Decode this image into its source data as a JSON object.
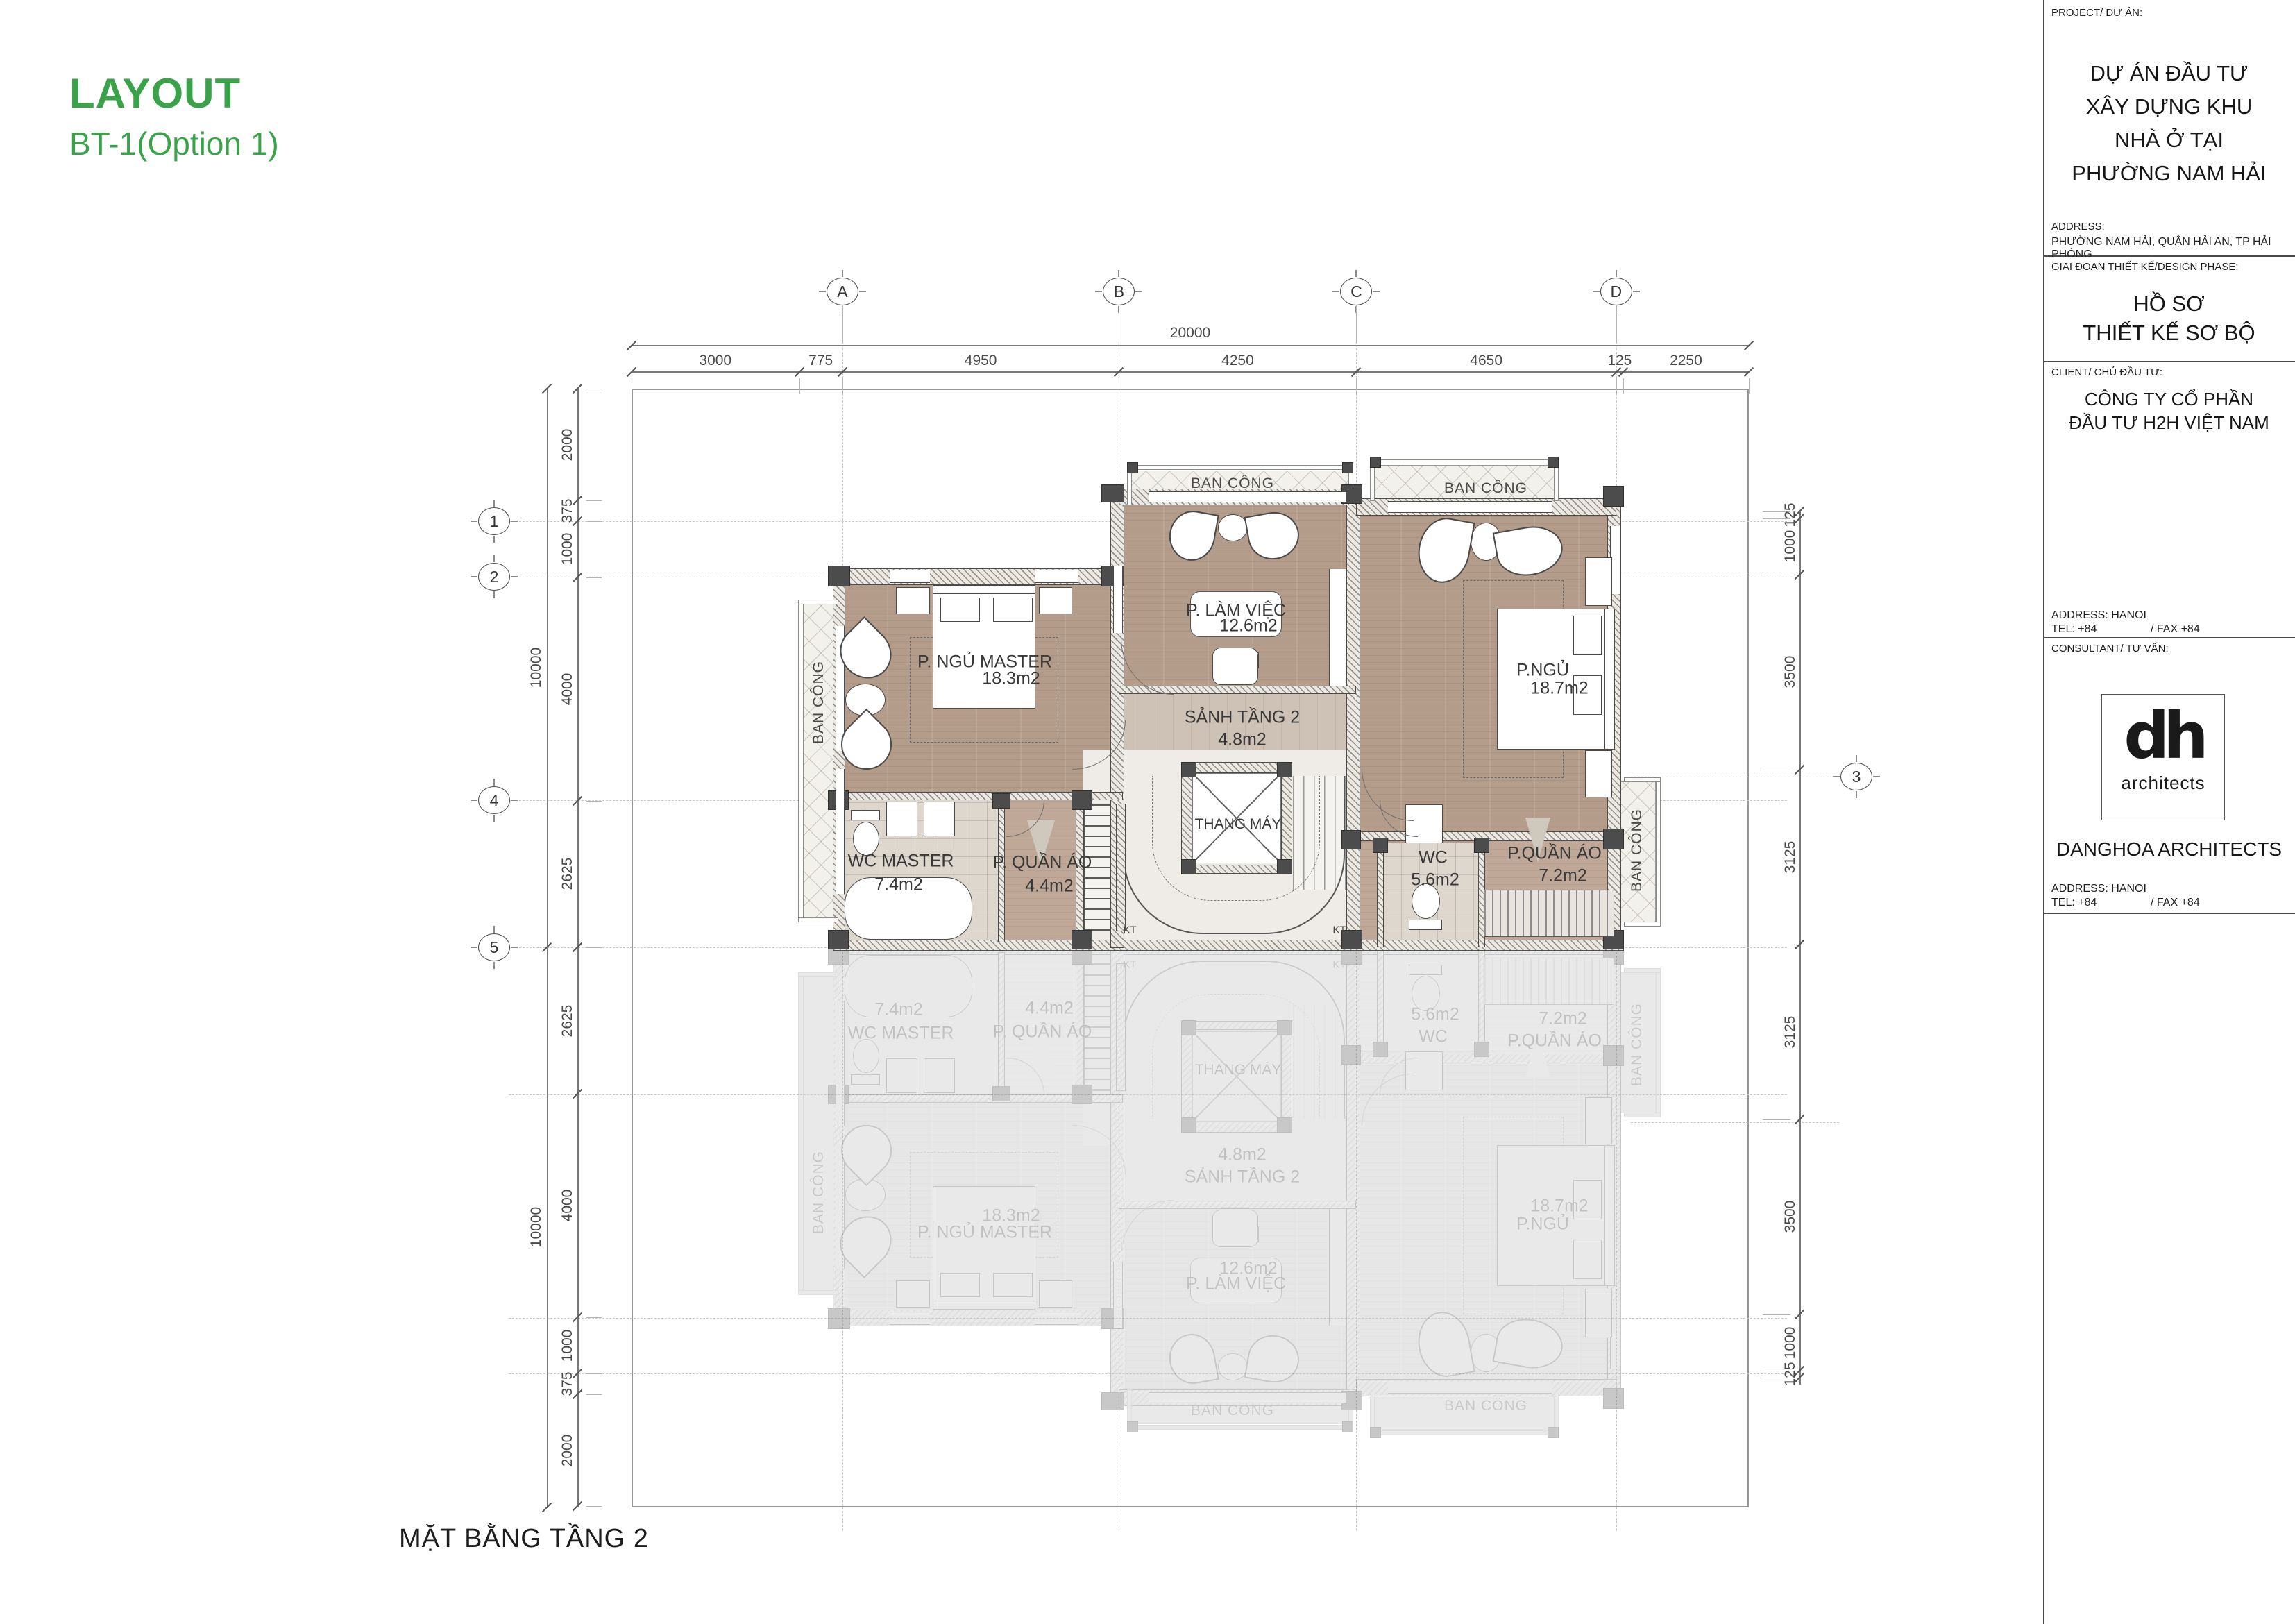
{
  "header": {
    "title": "LAYOUT",
    "subtitle": "BT-1(Option 1)"
  },
  "caption": "MẶT BẰNG TẦNG 2",
  "colors": {
    "accent_green": "#3aa34a",
    "wood_floor": "#b49c8b",
    "tile_floor": "#ddd7ce",
    "wall": "#4a4a4a"
  },
  "grid": {
    "top": [
      "A",
      "B",
      "C",
      "D"
    ],
    "left": [
      "1",
      "2",
      "4",
      "5"
    ],
    "right": [
      "3"
    ]
  },
  "dims": {
    "total_width": "20000",
    "total_height": "10000",
    "top": [
      "3000",
      "775",
      "4950",
      "4250",
      "4650",
      "125",
      "2250"
    ],
    "left_upper": [
      "2000",
      "375",
      "1000",
      "4000",
      "2625"
    ],
    "left_lower": [
      "2625",
      "4000",
      "1000",
      "375",
      "2000"
    ],
    "right_upper": [
      "125",
      "1000",
      "3500",
      "3125"
    ],
    "right_lower": [
      "3125",
      "3500",
      "1000",
      "125"
    ]
  },
  "rooms": {
    "master": {
      "name": "P. NGỦ MASTER",
      "area": "18.3m2"
    },
    "work": {
      "name": "P. LÀM VIỆC",
      "area": "12.6m2"
    },
    "bedroom": {
      "name": "P.NGỦ",
      "area": "18.7m2"
    },
    "hall": {
      "name": "SẢNH TẦNG 2",
      "area": "4.8m2"
    },
    "elevator": {
      "name": "THANG MÁY"
    },
    "wc_master": {
      "name": "WC MASTER",
      "area": "7.4m2"
    },
    "closet_small": {
      "name": "P. QUẦN ÁO",
      "area": "4.4m2"
    },
    "wc": {
      "name": "WC",
      "area": "5.6m2"
    },
    "closet_large": {
      "name": "P.QUẦN ÁO",
      "area": "7.2m2"
    },
    "balcony": {
      "name": "BAN CÔNG"
    },
    "shaft": {
      "name": "KT"
    }
  },
  "titleblock": {
    "project_label": "PROJECT/ DỰ ÁN:",
    "project_name": [
      "DỰ ÁN ĐẦU TƯ",
      "XÂY DỰNG KHU",
      "NHÀ Ở TẠI",
      "PHƯỜNG NAM HẢI"
    ],
    "address_label": "ADDRESS:",
    "address_value": "PHƯỜNG NAM HẢI, QUẬN HẢI AN, TP HẢI PHÒNG",
    "phase_label": "GIAI ĐOẠN THIẾT KẾ/DESIGN PHASE:",
    "phase_value": [
      "HỒ SƠ",
      "THIẾT KẾ SƠ BỘ"
    ],
    "client_label": "CLIENT/ CHỦ ĐẦU TƯ:",
    "client_value": [
      "CÔNG TY CỔ PHẦN",
      "ĐẦU TƯ H2H VIỆT NAM"
    ],
    "office_address": "ADDRESS: HANOI",
    "office_tel": "TEL: +84",
    "office_fax": "/ FAX +84",
    "consultant_label": "CONSULTANT/ TƯ VẤN:",
    "logo_main": "dh",
    "logo_sub": "architects",
    "consultant_name": "DANGHOA ARCHITECTS"
  }
}
